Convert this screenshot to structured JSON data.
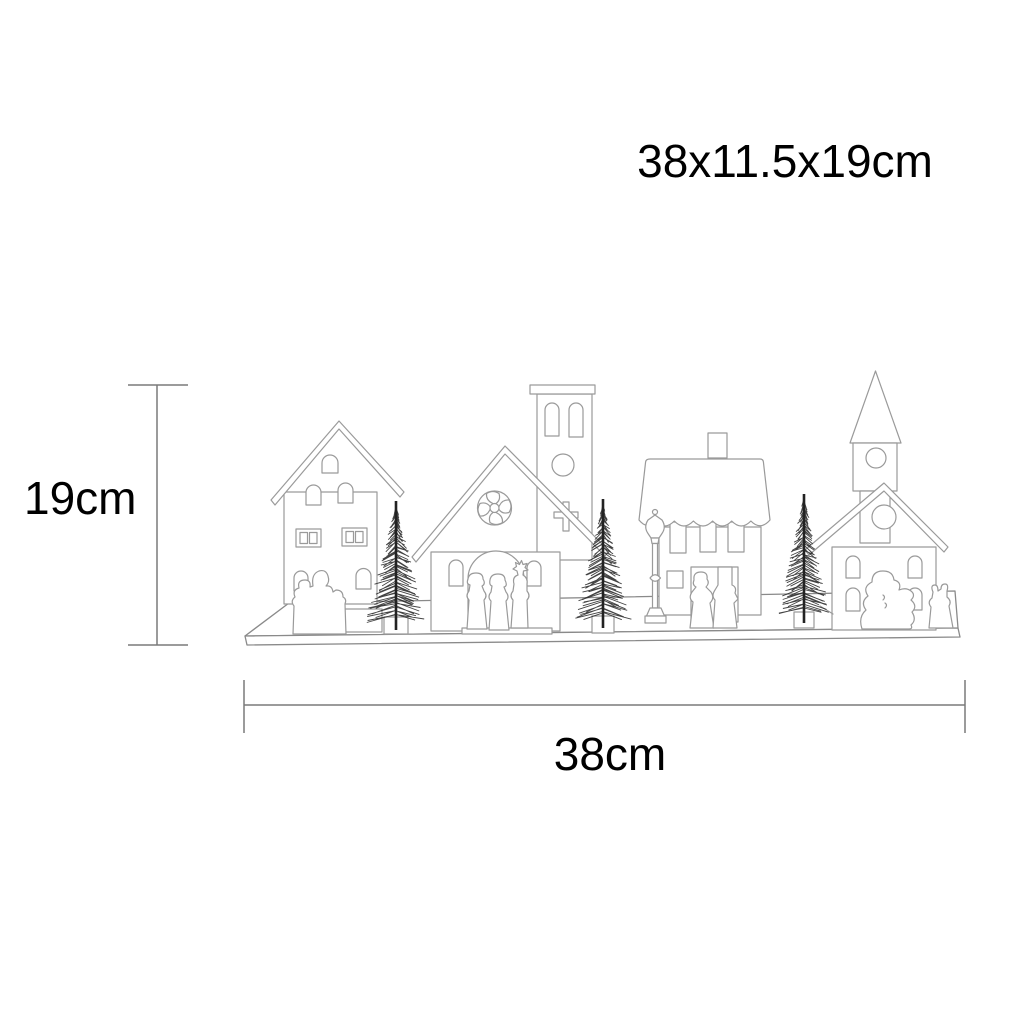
{
  "annotation": {
    "size_label": "38x11.5x19cm",
    "height_label": "19cm",
    "width_label": "38cm",
    "dimensions_cm": {
      "width": 38,
      "depth": 11.5,
      "height": 19
    }
  },
  "illustration": {
    "description": "Black-and-white line drawing of a wooden Christmas village silhouette on a rectangular base: two-story house with carolers, church with rose window and bell tower with cross, town house with scalloped roof and couple, chapel with steeple, three bottle-brush trees in pots, a lamppost, a snowman and a rabbit",
    "objects": [
      "two-story house",
      "caroler figures",
      "bottle-brush tree in pot",
      "church with rose window",
      "bell tower with cross",
      "nativity figures",
      "lamppost",
      "town house with scalloped roof",
      "couple figures",
      "chapel with steeple",
      "snowman",
      "rabbit",
      "display base"
    ]
  },
  "colors": {
    "background": "#ffffff",
    "line": "#9a9a9a",
    "dark": "#222222",
    "dimension_line": "#7a7a7a",
    "text": "#000000"
  }
}
